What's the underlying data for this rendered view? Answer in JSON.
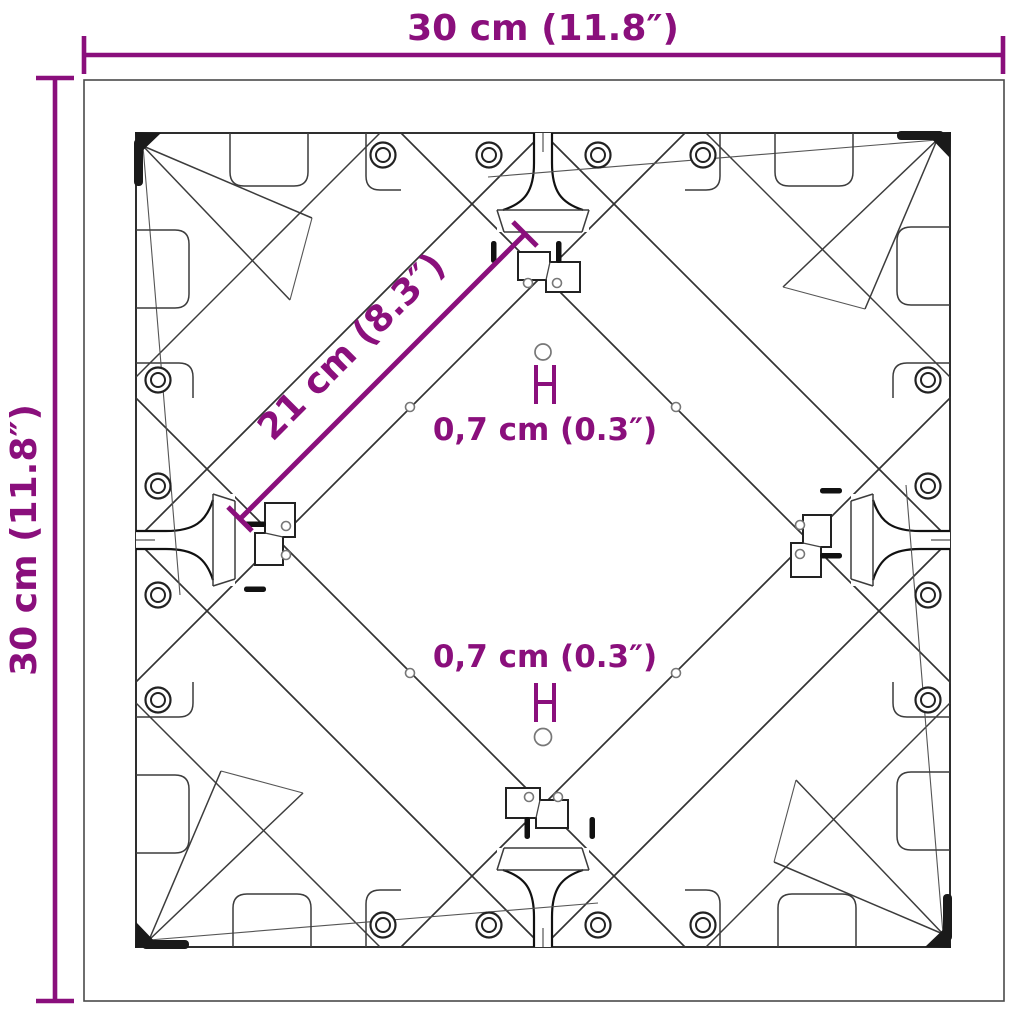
{
  "figure": {
    "type": "technical-dimension-diagram",
    "background_color": "#ffffff",
    "accent_color": "#8A0F7C",
    "line_color": "#333333",
    "labels": {
      "width_top": "30 cm (11.8″)",
      "height_left": "30 cm (11.8″)",
      "diagonal_bracket": "21 cm (8.3″)",
      "hole_top": "0,7 cm (0.3″)",
      "hole_bottom": "0,7 cm (0.3″)"
    }
  }
}
